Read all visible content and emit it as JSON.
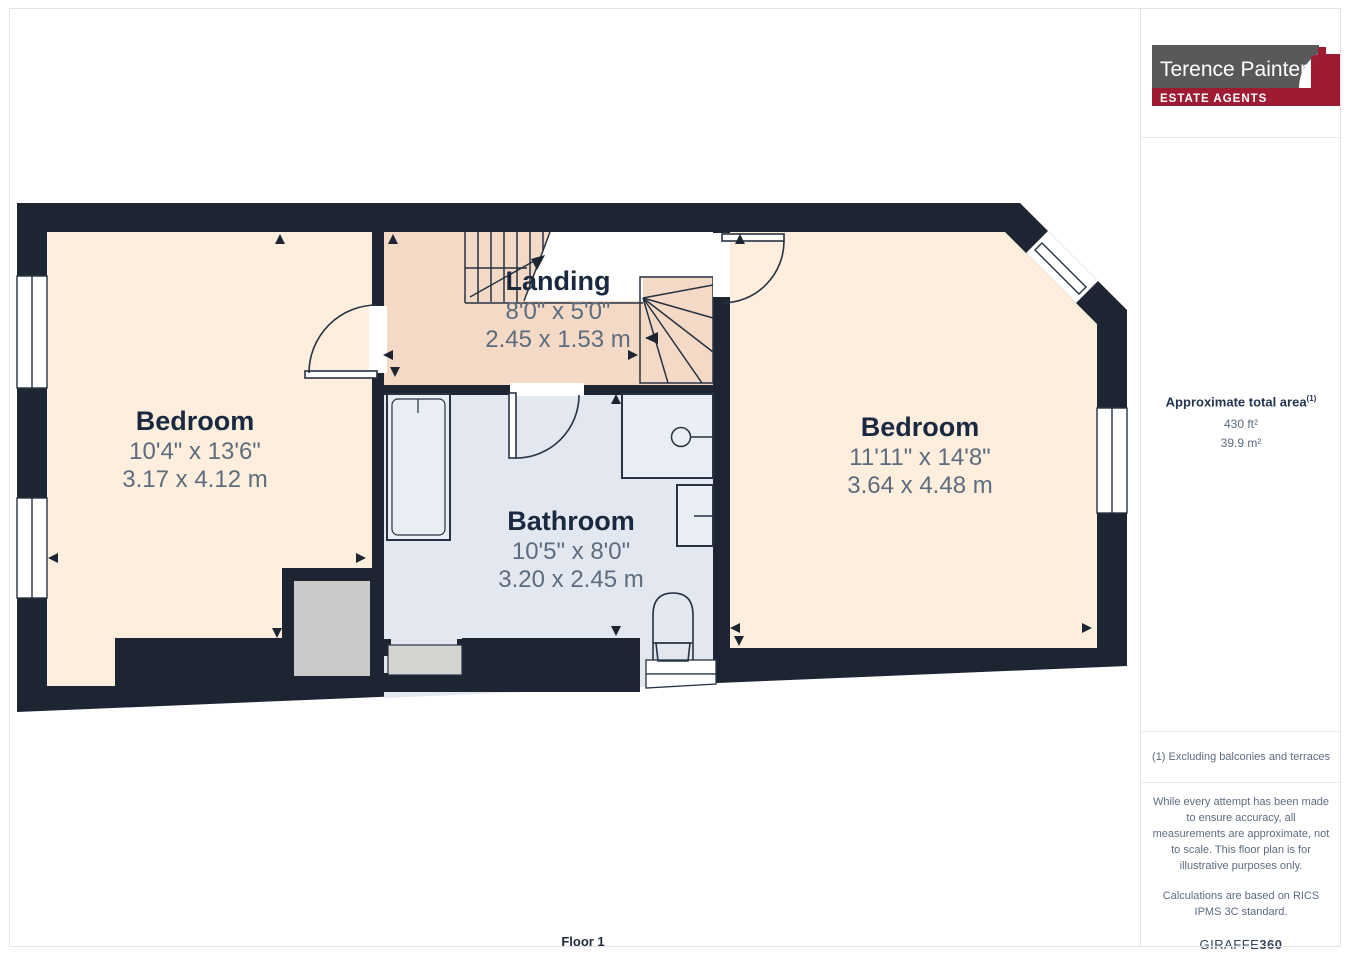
{
  "branding": {
    "agency_name": "Terence Painter",
    "agency_tagline": "ESTATE AGENTS",
    "brand_gray": "#59595b",
    "brand_red": "#9e1c33"
  },
  "sidebar": {
    "area_title": "Approximate total area",
    "area_superscript": "(1)",
    "area_ft": "430 ft²",
    "area_m": "39.9 m²",
    "footnote": "(1) Excluding balconies and terraces",
    "disclaimer": "While every attempt has been made to ensure accuracy, all measurements are approximate, not to scale. This floor plan is for illustrative purposes only.",
    "standard_note": "Calculations are based on RICS IPMS 3C standard.",
    "provider": "GIRAFFE",
    "provider_suffix": "360"
  },
  "floor": {
    "label": "Floor 1"
  },
  "rooms": [
    {
      "name": "Landing",
      "imperial": "8'0\" x 5'0\"",
      "metric": "2.45 x 1.53 m"
    },
    {
      "name": "Bedroom",
      "imperial": "10'4\" x 13'6\"",
      "metric": "3.17 x 4.12 m"
    },
    {
      "name": "Bathroom",
      "imperial": "10'5\" x 8'0\"",
      "metric": "3.20 x 2.45 m"
    },
    {
      "name": "Bedroom",
      "imperial": "11'11\" x 14'8\"",
      "metric": "3.64 x 4.48 m"
    }
  ],
  "colors": {
    "wall": "#1d2533",
    "bedroom_floor": "#fdeedd",
    "landing_floor": "#f4d9c6",
    "bathroom_floor": "#e2e7f0",
    "dimension_text": "#5d6c7f",
    "room_name_text": "#1b2940"
  }
}
